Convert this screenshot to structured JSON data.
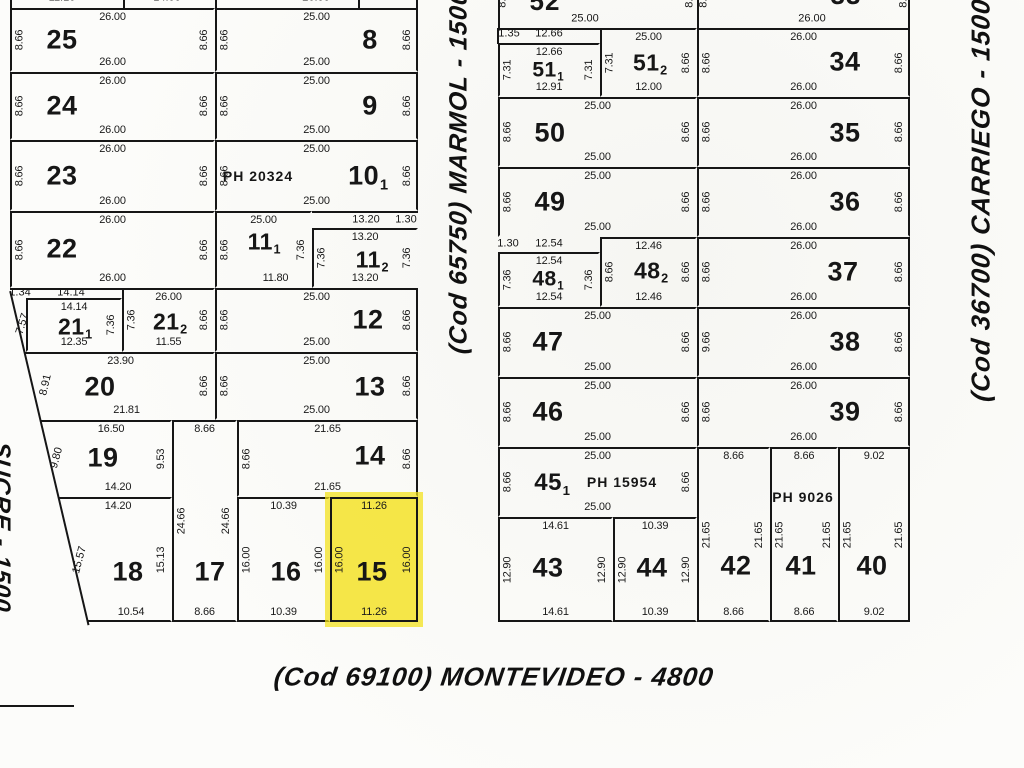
{
  "highlight_color": "#f3e016",
  "streets": {
    "left": {
      "text": "SUCRE - 1500"
    },
    "middle": {
      "text": "(Cod  65750)  MARMOL - 1500"
    },
    "right": {
      "text": "(Cod  36700)  CARRIEGO - 1500"
    },
    "bottom": {
      "text": "(Cod  69100)  MONTEVIDEO - 4800"
    }
  },
  "blocks": [
    {
      "id": "west",
      "clip": "10px 0px, 428px 0px, 428px 630px, 89px 630px, 10px 292px",
      "lots": [
        {
          "id": "25",
          "num": "25",
          "rect": [
            10,
            8,
            205,
            64
          ],
          "nx": 62,
          "ny": 40,
          "t": "26.00",
          "b": "26.00",
          "l": "8.66",
          "r": "8.66"
        },
        {
          "id": "8",
          "num": "8",
          "rect": [
            215,
            8,
            203,
            64
          ],
          "e": "r",
          "nx": 370,
          "ny": 40,
          "t": "25.00",
          "b": "25.00",
          "l": "8.66",
          "r": "8.66"
        },
        {
          "id": "24",
          "num": "24",
          "rect": [
            10,
            72,
            205,
            68
          ],
          "nx": 62,
          "ny": 106,
          "t": "26.00",
          "b": "26.00",
          "l": "8.66",
          "r": "8.66"
        },
        {
          "id": "9",
          "num": "9",
          "rect": [
            215,
            72,
            203,
            68
          ],
          "e": "r",
          "nx": 370,
          "ny": 106,
          "t": "25.00",
          "b": "25.00",
          "l": "8.66",
          "r": "8.66"
        },
        {
          "id": "23",
          "num": "23",
          "rect": [
            10,
            140,
            205,
            71
          ],
          "nx": 62,
          "ny": 176,
          "t": "26.00",
          "b": "26.00",
          "l": "8.66",
          "r": "8.66"
        },
        {
          "id": "10-1",
          "num": "10",
          "sub": "1",
          "rect": [
            215,
            140,
            203,
            71
          ],
          "e": "r",
          "nx": 368,
          "ny": 176,
          "t": "25.00",
          "b": "25.00",
          "l": "8.66",
          "r": "8.66",
          "ph": "PH 20324",
          "phx": 258,
          "phy": 176
        },
        {
          "id": "22",
          "num": "22",
          "rect": [
            10,
            211,
            205,
            77
          ],
          "nx": 62,
          "ny": 249,
          "t": "26.00",
          "b": "26.00",
          "l": "8.66",
          "r": "8.66"
        },
        {
          "id": "11-1",
          "num": "11",
          "sub": "1",
          "fs": 23,
          "rect": [
            215,
            211,
            97,
            77
          ],
          "nx": 264,
          "ny": 242,
          "t": "25.00",
          "b": "11.80",
          "bdx": 12,
          "l": "8.66",
          "r": "7.36"
        },
        {
          "id": "11-2",
          "num": "11",
          "sub": "2",
          "fs": 23,
          "rect": [
            312,
            228,
            106,
            60
          ],
          "nx": 372,
          "ny": 260,
          "t": "13.20",
          "b": "13.20",
          "l": "7.36",
          "r": "7.36"
        },
        {
          "id": "21-1",
          "num": "21",
          "sub": "1",
          "fs": 23,
          "rect": [
            26,
            298,
            96,
            54
          ],
          "nx": 75,
          "ny": 327,
          "t": "14.14",
          "b": "12.35",
          "r": "7.36"
        },
        {
          "id": "21-2",
          "num": "21",
          "sub": "2",
          "fs": 23,
          "rect": [
            122,
            288,
            93,
            64
          ],
          "nx": 170,
          "ny": 322,
          "t": "26.00",
          "b": "11.55",
          "l": "7.36",
          "r": "8.66"
        },
        {
          "id": "12",
          "num": "12",
          "rect": [
            215,
            288,
            203,
            64
          ],
          "e": "r",
          "nx": 368,
          "ny": 320,
          "t": "25.00",
          "b": "25.00",
          "l": "8.66",
          "r": "8.66"
        },
        {
          "id": "20",
          "num": "20",
          "rect": [
            10,
            352,
            205,
            68
          ],
          "e": "n",
          "nx": 100,
          "ny": 387,
          "t": "23.90",
          "tdx": 8,
          "b": "21.81",
          "bdx": 14,
          "r": "8.66"
        },
        {
          "id": "13",
          "num": "13",
          "rect": [
            215,
            352,
            203,
            68
          ],
          "e": "r",
          "nx": 370,
          "ny": 387,
          "t": "25.00",
          "b": "25.00",
          "l": "8.66",
          "r": "8.66"
        },
        {
          "id": "19",
          "num": "19",
          "rect": [
            10,
            420,
            162,
            77
          ],
          "e": "n",
          "nx": 103,
          "ny": 458,
          "t": "16.50",
          "tdx": 20,
          "b": "14.20",
          "bdx": 27,
          "r": "9.53"
        },
        {
          "id": "17",
          "num": "17",
          "rect": [
            172,
            420,
            65,
            202
          ],
          "e": "b",
          "nx": 210,
          "ny": 572,
          "t": "8.66",
          "b": "8.66",
          "l": "24.66",
          "r": "24.66"
        },
        {
          "id": "14",
          "num": "14",
          "rect": [
            237,
            420,
            181,
            77
          ],
          "e": "r",
          "nx": 370,
          "ny": 456,
          "t": "21.65",
          "b": "21.65",
          "l": "8.66",
          "r": "8.66"
        },
        {
          "id": "18",
          "num": "18",
          "rect": [
            10,
            497,
            162,
            125
          ],
          "e": "nb",
          "nx": 128,
          "ny": 572,
          "t": "14.20",
          "tdx": 27,
          "b": "10.54",
          "bdx": 40,
          "r": "15.13"
        },
        {
          "id": "16",
          "num": "16",
          "rect": [
            237,
            497,
            93,
            125
          ],
          "e": "b",
          "nx": 286,
          "ny": 572,
          "t": "10.39",
          "b": "10.39",
          "l": "16.00",
          "r": "16.00"
        },
        {
          "id": "15",
          "num": "15",
          "rect": [
            330,
            497,
            88,
            125
          ],
          "e": "rb",
          "hl": true,
          "nx": 372,
          "ny": 572,
          "t": "11.26",
          "b": "11.26",
          "l": "16.00",
          "r": "16.00"
        }
      ]
    },
    {
      "id": "east",
      "clip": "",
      "lots": [
        {
          "id": "51-2",
          "num": "51",
          "sub": "2",
          "fs": 23,
          "rect": [
            600,
            28,
            97,
            69
          ],
          "nx": 650,
          "ny": 63,
          "t": "25.00",
          "b": "12.00",
          "l": "7.31",
          "r": "8.66"
        },
        {
          "id": "34",
          "num": "34",
          "rect": [
            697,
            28,
            213,
            69
          ],
          "e": "r",
          "nx": 845,
          "ny": 62,
          "t": "26.00",
          "b": "26.00",
          "l": "8.66",
          "r": "8.66"
        },
        {
          "id": "51-1",
          "num": "51",
          "sub": "1",
          "fs": 21,
          "rect": [
            498,
            43,
            102,
            54
          ],
          "nx": 548,
          "ny": 70,
          "t": "12.66",
          "b": "12.91",
          "l": "7.31",
          "r": "7.31"
        },
        {
          "id": "50",
          "num": "50",
          "rect": [
            498,
            97,
            199,
            70
          ],
          "nx": 550,
          "ny": 133,
          "t": "25.00",
          "b": "25.00",
          "l": "8.66",
          "r": "8.66"
        },
        {
          "id": "35",
          "num": "35",
          "rect": [
            697,
            97,
            213,
            70
          ],
          "e": "r",
          "nx": 845,
          "ny": 133,
          "t": "26.00",
          "b": "26.00",
          "l": "8.66",
          "r": "8.66"
        },
        {
          "id": "49",
          "num": "49",
          "rect": [
            498,
            167,
            199,
            70
          ],
          "nx": 550,
          "ny": 202,
          "t": "25.00",
          "b": "25.00",
          "l": "8.66",
          "r": "8.66"
        },
        {
          "id": "36",
          "num": "36",
          "rect": [
            697,
            167,
            213,
            70
          ],
          "e": "r",
          "nx": 845,
          "ny": 202,
          "t": "26.00",
          "b": "26.00",
          "l": "8.66",
          "r": "8.66"
        },
        {
          "id": "48-2",
          "num": "48",
          "sub": "2",
          "fs": 23,
          "rect": [
            600,
            237,
            97,
            70
          ],
          "nx": 651,
          "ny": 271,
          "t": "12.46",
          "b": "12.46",
          "l": "8.66",
          "r": "8.66"
        },
        {
          "id": "37",
          "num": "37",
          "rect": [
            697,
            237,
            213,
            70
          ],
          "e": "r",
          "nx": 843,
          "ny": 272,
          "t": "26.00",
          "b": "26.00",
          "l": "8.66",
          "r": "8.66"
        },
        {
          "id": "48-1",
          "num": "48",
          "sub": "1",
          "fs": 21,
          "rect": [
            498,
            252,
            102,
            55
          ],
          "nx": 548,
          "ny": 279,
          "t": "12.54",
          "b": "12.54",
          "l": "7.36",
          "r": "7.36"
        },
        {
          "id": "47",
          "num": "47",
          "rect": [
            498,
            307,
            199,
            70
          ],
          "nx": 548,
          "ny": 342,
          "t": "25.00",
          "b": "25.00",
          "l": "8.66",
          "r": "8.66"
        },
        {
          "id": "38",
          "num": "38",
          "rect": [
            697,
            307,
            213,
            70
          ],
          "e": "r",
          "nx": 845,
          "ny": 342,
          "t": "26.00",
          "b": "26.00",
          "l": "9.66",
          "r": "8.66"
        },
        {
          "id": "46",
          "num": "46",
          "rect": [
            498,
            377,
            199,
            70
          ],
          "nx": 548,
          "ny": 412,
          "t": "25.00",
          "b": "25.00",
          "l": "8.66",
          "r": "8.66"
        },
        {
          "id": "39",
          "num": "39",
          "rect": [
            697,
            377,
            213,
            70
          ],
          "e": "r",
          "nx": 845,
          "ny": 412,
          "t": "26.00",
          "b": "26.00",
          "l": "8.66",
          "r": "8.66"
        },
        {
          "id": "45-1",
          "num": "45",
          "sub": "1",
          "fs": 24,
          "rect": [
            498,
            447,
            199,
            70
          ],
          "nx": 552,
          "ny": 483,
          "t": "25.00",
          "b": "25.00",
          "l": "8.66",
          "r": "8.66",
          "ph": "PH 15954",
          "phx": 622,
          "phy": 482
        },
        {
          "id": "42",
          "num": "42",
          "rect": [
            697,
            447,
            73,
            175
          ],
          "e": "b",
          "nx": 736,
          "ny": 566,
          "t": "8.66",
          "b": "8.66",
          "l": "21.65",
          "r": "21.65"
        },
        {
          "id": "41",
          "num": "41",
          "rect": [
            770,
            447,
            68,
            175
          ],
          "e": "b",
          "nx": 801,
          "ny": 566,
          "t": "8.66",
          "b": "8.66",
          "l": "21.65",
          "r": "21.65",
          "ph": "PH 9026",
          "phx": 803,
          "phy": 497
        },
        {
          "id": "40",
          "num": "40",
          "rect": [
            838,
            447,
            72,
            175
          ],
          "e": "rb",
          "nx": 872,
          "ny": 566,
          "t": "9.02",
          "b": "9.02",
          "l": "21.65",
          "r": "21.65"
        },
        {
          "id": "43",
          "num": "43",
          "rect": [
            498,
            517,
            115,
            105
          ],
          "e": "b",
          "nx": 548,
          "ny": 568,
          "t": "14.61",
          "b": "14.61",
          "l": "12.90",
          "r": "12.90"
        },
        {
          "id": "44",
          "num": "44",
          "rect": [
            613,
            517,
            84,
            105
          ],
          "e": "b",
          "nx": 652,
          "ny": 568,
          "t": "10.39",
          "b": "10.39",
          "l": "12.90",
          "r": "12.90"
        }
      ]
    }
  ],
  "annotations": [
    {
      "v": "1.34",
      "x": 20,
      "y": 293
    },
    {
      "v": "14.14",
      "x": 71,
      "y": 293
    },
    {
      "v": "7.57",
      "x": 23,
      "y": 324,
      "rot": -72
    },
    {
      "v": "8.91",
      "x": 46,
      "y": 385,
      "rot": -77
    },
    {
      "v": "9.80",
      "x": 57,
      "y": 458,
      "rot": -75
    },
    {
      "v": "15.57",
      "x": 80,
      "y": 560,
      "rot": -75
    },
    {
      "v": "13.20",
      "x": 366,
      "y": 220
    },
    {
      "v": "1.30",
      "x": 406,
      "y": 220
    },
    {
      "v": "1.35",
      "x": 509,
      "y": 34
    },
    {
      "v": "12.66",
      "x": 549,
      "y": 34
    },
    {
      "v": "1.30",
      "x": 508,
      "y": 244
    },
    {
      "v": "12.54",
      "x": 549,
      "y": 244
    },
    {
      "v": "52",
      "x": 545,
      "y": 1,
      "cls": "num-big"
    },
    {
      "v": "33",
      "x": 846,
      "y": -5,
      "cls": "num-big"
    },
    {
      "v": "25.00",
      "x": 585,
      "y": 19
    },
    {
      "v": "26.00",
      "x": 812,
      "y": 19
    },
    {
      "v": "8.66",
      "x": 503,
      "y": -3,
      "rot": -90
    },
    {
      "v": "8.66",
      "x": 690,
      "y": -3,
      "rot": -90
    },
    {
      "v": "8.66",
      "x": 704,
      "y": -3,
      "rot": -90
    },
    {
      "v": "8.66",
      "x": 904,
      "y": -3,
      "rot": -90
    },
    {
      "v": "11.10",
      "x": 62,
      "y": -2
    },
    {
      "v": "14.00",
      "x": 167,
      "y": -2
    },
    {
      "v": "26.00",
      "x": 316,
      "y": -2
    }
  ],
  "lines": [
    {
      "x": 10,
      "y": 290,
      "len": 343,
      "rot": 76.8
    },
    {
      "x": 312,
      "y": 211,
      "w": 106,
      "h": 2
    },
    {
      "x": 10,
      "y": 288,
      "w": 114,
      "h": 2
    },
    {
      "x": 498,
      "y": 28,
      "w": 104,
      "h": 2
    },
    {
      "x": 497,
      "y": 28,
      "w": 2,
      "h": 16
    },
    {
      "x": 10,
      "y": 0,
      "w": 2,
      "h": 8
    },
    {
      "x": 123,
      "y": 0,
      "w": 2,
      "h": 8
    },
    {
      "x": 215,
      "y": 0,
      "w": 2,
      "h": 8
    },
    {
      "x": 358,
      "y": 0,
      "w": 2,
      "h": 8
    },
    {
      "x": 416,
      "y": 0,
      "w": 2,
      "h": 8
    },
    {
      "x": 498,
      "y": 0,
      "w": 2,
      "h": 28
    },
    {
      "x": 697,
      "y": 0,
      "w": 2,
      "h": 28
    },
    {
      "x": 908,
      "y": 0,
      "w": 2,
      "h": 28
    },
    {
      "x": 0,
      "y": 705,
      "w": 74,
      "h": 2
    }
  ]
}
